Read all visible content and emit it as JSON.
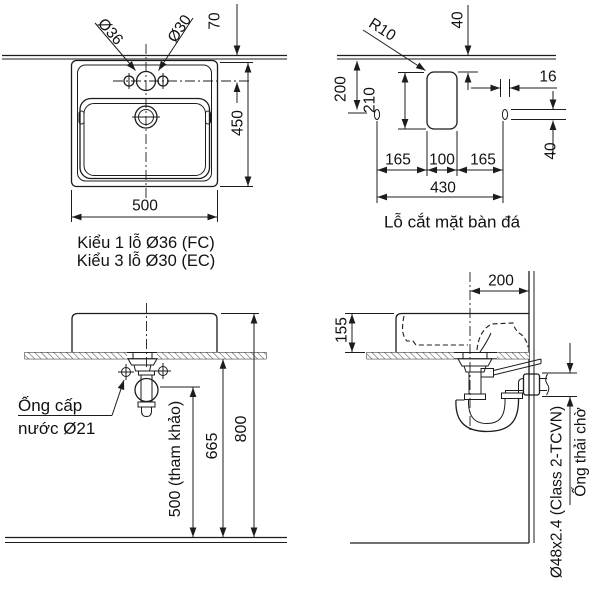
{
  "views": {
    "top": {
      "dim_hole_main": "Ø36",
      "dim_hole_side": "Ø30",
      "dim_hole_offset": "70",
      "dim_depth": "450",
      "dim_width": "500",
      "caption_line1": "Kiểu 1 lỗ Ø36 (FC)",
      "caption_line2": "Kiểu 3 lỗ Ø30 (EC)"
    },
    "cutout": {
      "dim_radius": "R10",
      "dim_top_clearance": "40",
      "dim_front_depth": "200",
      "dim_cut_depth": "210",
      "dim_slot_width": "16",
      "dim_slot_height": "40",
      "dim_left": "165",
      "dim_center": "100",
      "dim_right": "165",
      "dim_total_width": "430",
      "caption": "Lỗ cắt mặt bàn đá"
    },
    "front": {
      "label_supply_1": "Ống cấp",
      "label_supply_2": "nước Ø21",
      "dim_ref_height": "500 (tham khảo)",
      "dim_under_counter": "665",
      "dim_rim_height": "800"
    },
    "side": {
      "dim_wall_offset": "200",
      "dim_above_counter": "155",
      "label_drain_spec": "Ø48x2.4 (Class 2-TCVN)",
      "label_drain_name": "Ống thải chờ"
    }
  }
}
